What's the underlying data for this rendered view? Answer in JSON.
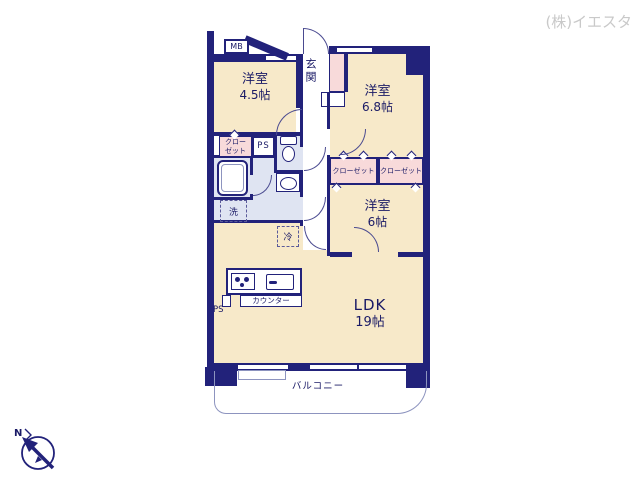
{
  "watermark": "(株)イエスタ",
  "compass": {
    "label": "N"
  },
  "colors": {
    "wall": "#22227a",
    "room_beige": "#f7e9c9",
    "closet_pink": "#f8dada",
    "wet_area_blue": "#dfe4f2",
    "balcony_line": "#8d94bf",
    "watermark_gray": "#c9c9c9"
  },
  "floorplan": {
    "rooms": {
      "bedroom1": {
        "name": "洋室",
        "size": "4.5帖"
      },
      "bedroom2": {
        "name": "洋室",
        "size": "6.8帖"
      },
      "bedroom3": {
        "name": "洋室",
        "size": "6帖"
      },
      "ldk": {
        "name": "LDK",
        "size": "19帖"
      },
      "entrance": {
        "name": "玄関"
      },
      "balcony": {
        "name": "バルコニー"
      }
    },
    "labels": {
      "meter_box": "MB",
      "pipe_space_top": "PS",
      "pipe_space_kitchen": "PS",
      "closet_west": "クローゼット",
      "closet_mid": "クローゼット",
      "closet_east": "クローゼット",
      "washer": "洗",
      "fridge": "冷",
      "counter": "カウンター"
    }
  }
}
